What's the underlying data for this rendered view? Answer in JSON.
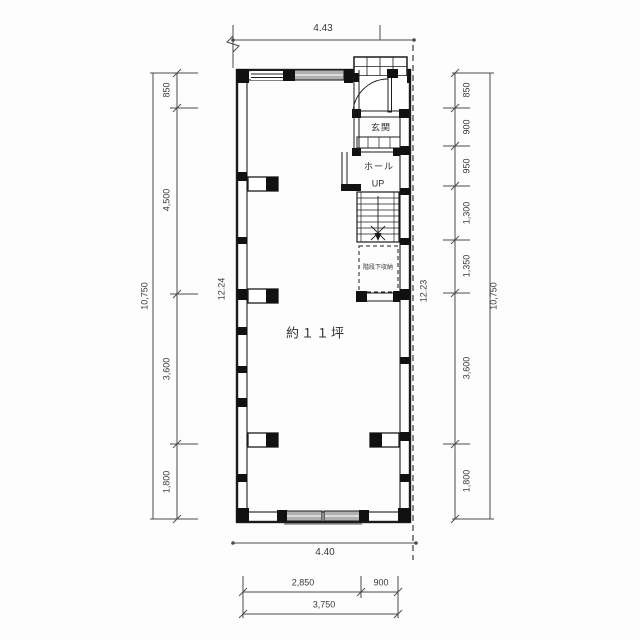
{
  "plan": {
    "area_label": "約１１坪",
    "rooms": {
      "genkan": "玄関",
      "hall": "ホール",
      "up": "UP",
      "under_stair_storage": "階段下収納"
    }
  },
  "dimensions": {
    "top_width_m": "4.43",
    "bottom_width_m": "4.40",
    "left": {
      "segments": [
        "850",
        "4,500",
        "3,600",
        "1,800"
      ],
      "overall": "10,750",
      "inner_height": "12.24"
    },
    "right": {
      "segments": [
        "850",
        "900",
        "950",
        "1,300",
        "1,350",
        "3,600",
        "1,800"
      ],
      "overall": "10,750",
      "inner_height": "12.23"
    },
    "bottom": {
      "segments": [
        "2,850",
        "900"
      ],
      "overall": "3,750"
    }
  },
  "colors": {
    "wall": "#1c1c1c",
    "dimension_line": "#4a4a4a",
    "text": "#3a3a3a",
    "window_fill": "#b0b0b0",
    "background": "#ffffff"
  }
}
